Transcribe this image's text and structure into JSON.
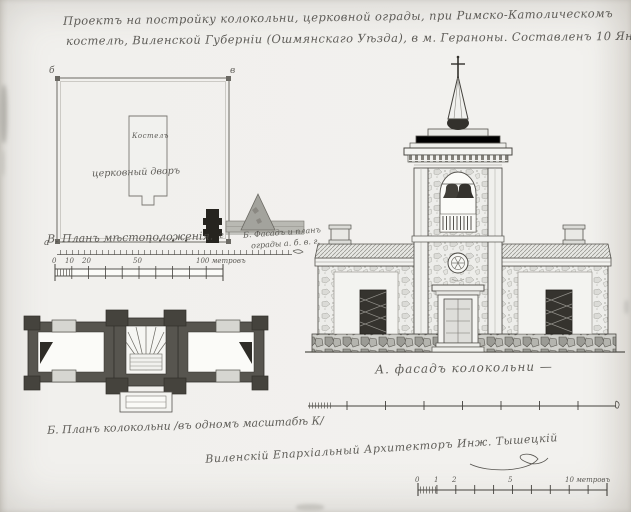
{
  "title": {
    "line1": "Проектъ на постройку колокольни, церковной ограды, при Римско-Католическомъ",
    "line2": "костелѣ, Виленской Губерніи (Ошмянскаго Уѣзда), в м. Гераноны. Составленъ 10 Января 1888 г."
  },
  "site_plan": {
    "corner_top_left": "б",
    "corner_top_right": "в",
    "corner_bottom_left": "а",
    "corner_bottom_right": "г",
    "building_label": "Костелъ",
    "yard_label": "церковный дворъ",
    "caption": "В. Планъ мѣстоположенія."
  },
  "fence_sketch": {
    "caption_line1": "Б. Фасадъ и планъ",
    "caption_line2": "ограды а. б. в. г."
  },
  "scale_site": {
    "labels": [
      "0",
      "10",
      "20",
      "50",
      "100 метровъ"
    ]
  },
  "elevation": {
    "caption": "А. фасадъ колокольни —"
  },
  "floor_plan": {
    "caption": "Б. Планъ колокольни /въ одномъ масштабѣ К/"
  },
  "signature": {
    "text": "Виленскій Епархіальный Архитекторъ Инж. Тышецкій"
  },
  "scale_facade": {
    "labels": [
      "0",
      "1",
      "2",
      "5",
      "10 метровъ"
    ]
  }
}
